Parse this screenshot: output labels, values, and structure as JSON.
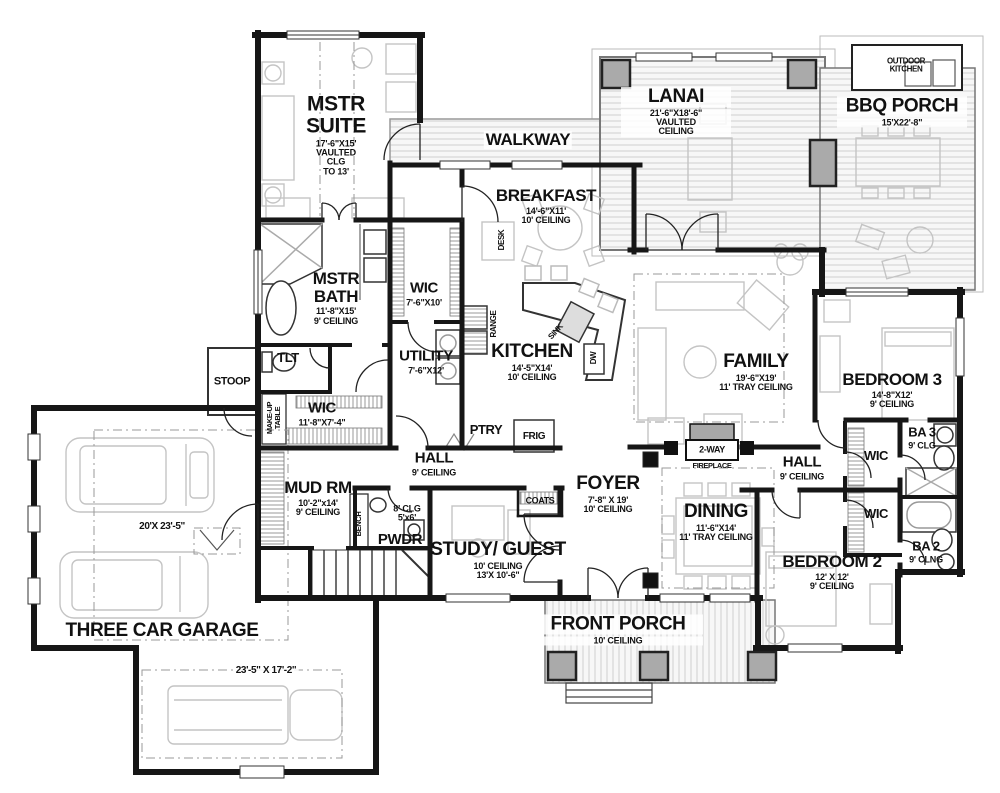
{
  "document": {
    "type": "single-story house floor plan"
  },
  "colors": {
    "wall": "#161616",
    "deck_line": "#c9c9c9",
    "column_fill": "#a8a8a8",
    "furniture_line": "#c4c4c4"
  },
  "labels": {
    "mstr_suite": {
      "name": "MSTR SUITE",
      "info": "17'-6\"X15'\nVAULTED\nCLG\nTO 13'"
    },
    "walkway": {
      "name": "WALKWAY"
    },
    "lanai": {
      "name": "LANAI",
      "info": "21'-6\"X18'-6\"\nVAULTED\nCEILING"
    },
    "outdoor_kitchen": {
      "name": "OUTDOOR KITCHEN"
    },
    "bbq_porch": {
      "name": "BBQ PORCH",
      "info": "15'X22'-8\""
    },
    "breakfast": {
      "name": "BREAKFAST",
      "info": "14'-6\"X11'\n10' CEILING"
    },
    "mstr_bath": {
      "name": "MSTR BATH",
      "info": "11'-8\"X15'\n9' CEILING"
    },
    "wic_mstr": {
      "name": "WIC",
      "info": "7'-6\"X10'"
    },
    "tlt": {
      "name": "TLT"
    },
    "stoop": {
      "name": "STOOP"
    },
    "makeup_table": {
      "name": "MAKE-UP TABLE"
    },
    "wic_mstr2": {
      "name": "WIC",
      "info": "11'-8\"X7'-4\""
    },
    "utility": {
      "name": "UTILITY",
      "info": "7'-6\"X12'"
    },
    "kitchen": {
      "name": "KITCHEN",
      "info": "14'-5\"X14'\n10' CEILING"
    },
    "range": {
      "name": "RANGE"
    },
    "sink": {
      "name": "SINK"
    },
    "dw": {
      "name": "DW"
    },
    "desk": {
      "name": "DESK"
    },
    "family": {
      "name": "FAMILY",
      "info": "19'-6\"X19'\n11' TRAY CEILING"
    },
    "bedroom3": {
      "name": "BEDROOM 3",
      "info": "14'-8\"X12'\n9' CEILING"
    },
    "ptry": {
      "name": "PTRY"
    },
    "frig": {
      "name": "FRIG"
    },
    "hall_center": {
      "name": "HALL",
      "info": "9' CEILING"
    },
    "foyer": {
      "name": "FOYER",
      "info": "7'-8\" X 19'\n10' CEILING"
    },
    "coats": {
      "name": "COATS"
    },
    "fireplace": {
      "name": "2-WAY",
      "info": "FIREPLACE"
    },
    "hall_right": {
      "name": "HALL",
      "info": "9' CEILING"
    },
    "wic_r1": {
      "name": "WIC"
    },
    "ba3": {
      "name": "BA 3",
      "info": "9' CLG"
    },
    "dining": {
      "name": "DINING",
      "info": "11'-6\"X14'\n11' TRAY CEILING"
    },
    "wic_r2": {
      "name": "WIC"
    },
    "ba2": {
      "name": "BA 2",
      "info": "9' CLNG"
    },
    "bedroom2": {
      "name": "BEDROOM 2",
      "info": "12' X 12'\n9' CEILING"
    },
    "mud_rm": {
      "name": "MUD RM",
      "info": "10'-2\"x14'\n9' CEILING"
    },
    "bench": {
      "name": "BENCH"
    },
    "pwdr": {
      "name": "PWDR",
      "info": "8' CLG\n5'x6'"
    },
    "study": {
      "name": "STUDY/ GUEST",
      "info": "10' CEILING\n13'X 10'-6\""
    },
    "front_porch": {
      "name": "FRONT PORCH",
      "info": "10' CEILING"
    },
    "garage": {
      "name": "THREE CAR GARAGE",
      "dim1": "20'X 23'-5\"",
      "dim2": "23'-5\" X 17'-2\""
    }
  }
}
